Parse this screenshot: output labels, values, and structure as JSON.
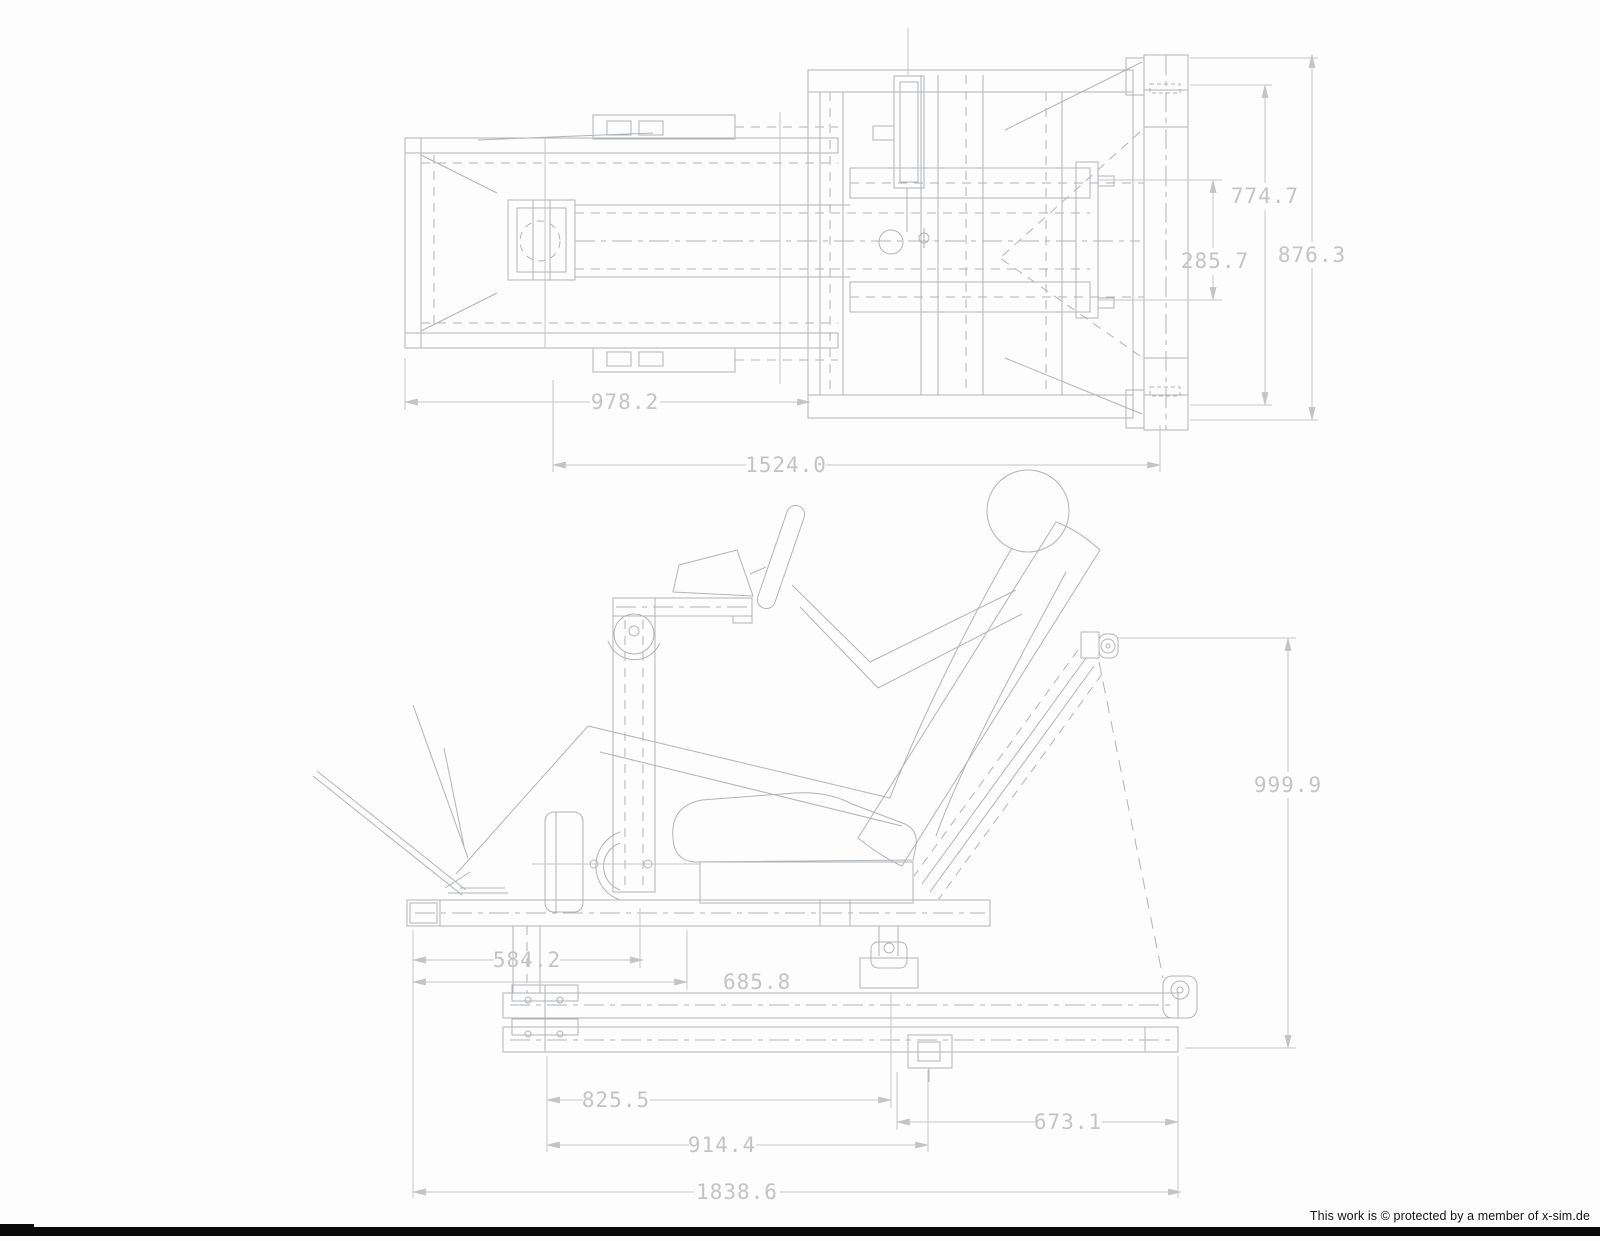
{
  "document": {
    "type": "cad-technical-drawing",
    "subject": "racing simulator seat frame, plan view and side view with seated driver",
    "line_color": "#b1b4b7",
    "dim_color": "#c2c4c6",
    "background": "#fdfdfd"
  },
  "top_view": {
    "dims": {
      "rail_span": "978.2",
      "overall_width": "1524.0",
      "inner_height": "285.7",
      "frame_height": "774.7",
      "overall_height": "876.3"
    }
  },
  "side_view": {
    "dims": {
      "pedal_to_column": "584.2",
      "base_to_seat": "685.8",
      "rail_front": "825.5",
      "rail_mid": "914.4",
      "rail_rear": "673.1",
      "overall_length": "1838.6",
      "overall_height": "999.9"
    }
  },
  "footer": {
    "copyright": "This work is © protected by a member of x-sim.de"
  }
}
